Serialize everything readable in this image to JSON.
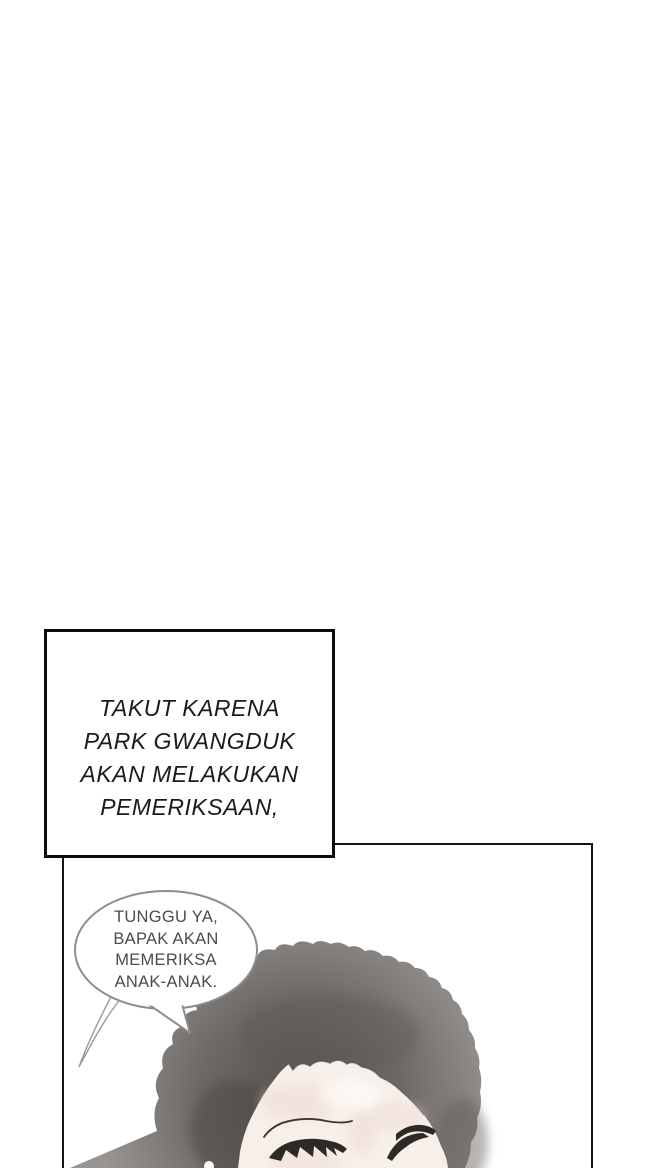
{
  "caption_box": {
    "lines": [
      "TAKUT KARENA",
      "PARK GWANGDUK",
      "AKAN MELAKUKAN",
      "PEMERIKSAAN,"
    ]
  },
  "speech_bubble": {
    "lines": [
      "TUNGGU YA,",
      "BAPAK AKAN",
      "MEMERIKSA",
      "ANAK-ANAK."
    ]
  },
  "artwork": {
    "subject": "person with large afro hair, eyes closed, head tilted, inside comic panel"
  },
  "colors": {
    "caption_text": "#1b1b1b",
    "caption_border": "#0c0c0c",
    "panel_border": "#141414",
    "bubble_border": "#8d8d8d",
    "bubble_text": "#4b4b4b",
    "hair_dark": "#55504d",
    "hair_mid": "#6e6966",
    "hair_light": "#989593",
    "skin": "#f7efe9",
    "skin_shadow": "#ecdbd3",
    "skin_highlight": "#fdf9f5",
    "lash": "#2d2925",
    "background": "#ffffff"
  }
}
